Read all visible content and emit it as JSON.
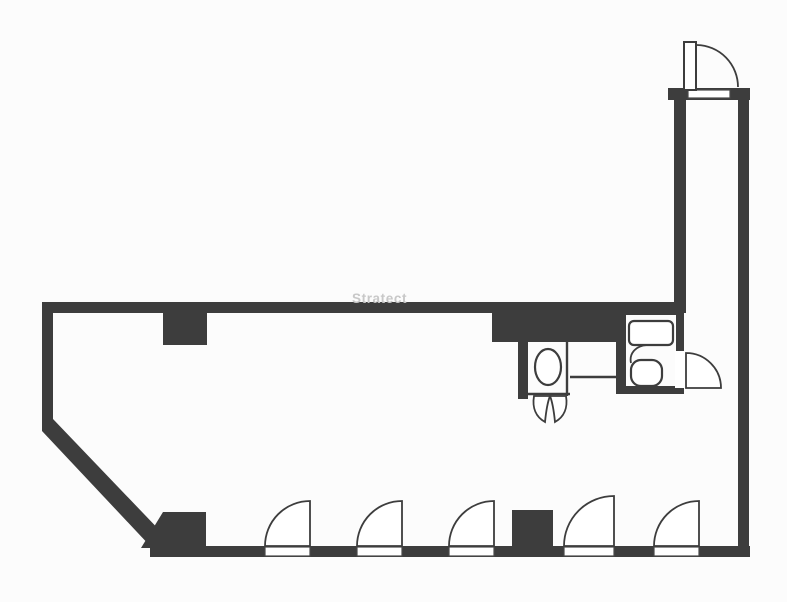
{
  "watermark": {
    "text": "Stratect"
  },
  "colors": {
    "wall": "#3d3d3d",
    "line": "#4a4a4a",
    "background": "#fcfcfc",
    "watermark": "#c8c8c8"
  },
  "floorplan": {
    "type": "architectural-floor-plan",
    "rooms": [
      "main-open-space",
      "entry-corridor",
      "wc-left",
      "wc-right"
    ],
    "swing_doors_bottom_wall": [
      {
        "hinge_x": 310,
        "open_from_x": 265
      },
      {
        "hinge_x": 402,
        "open_from_x": 357
      },
      {
        "hinge_x": 494,
        "open_from_x": 449
      },
      {
        "hinge_x": 614,
        "open_from_x": 564
      },
      {
        "hinge_x": 699,
        "open_from_x": 654
      }
    ],
    "columns": [
      {
        "x": 163,
        "y": 313,
        "w": 44,
        "h": 32
      },
      {
        "x": 512,
        "y": 510,
        "w": 41,
        "h": 38
      }
    ],
    "fixtures": [
      "wash-basin-round",
      "double-swing-door",
      "sink-counter",
      "toilet"
    ]
  }
}
